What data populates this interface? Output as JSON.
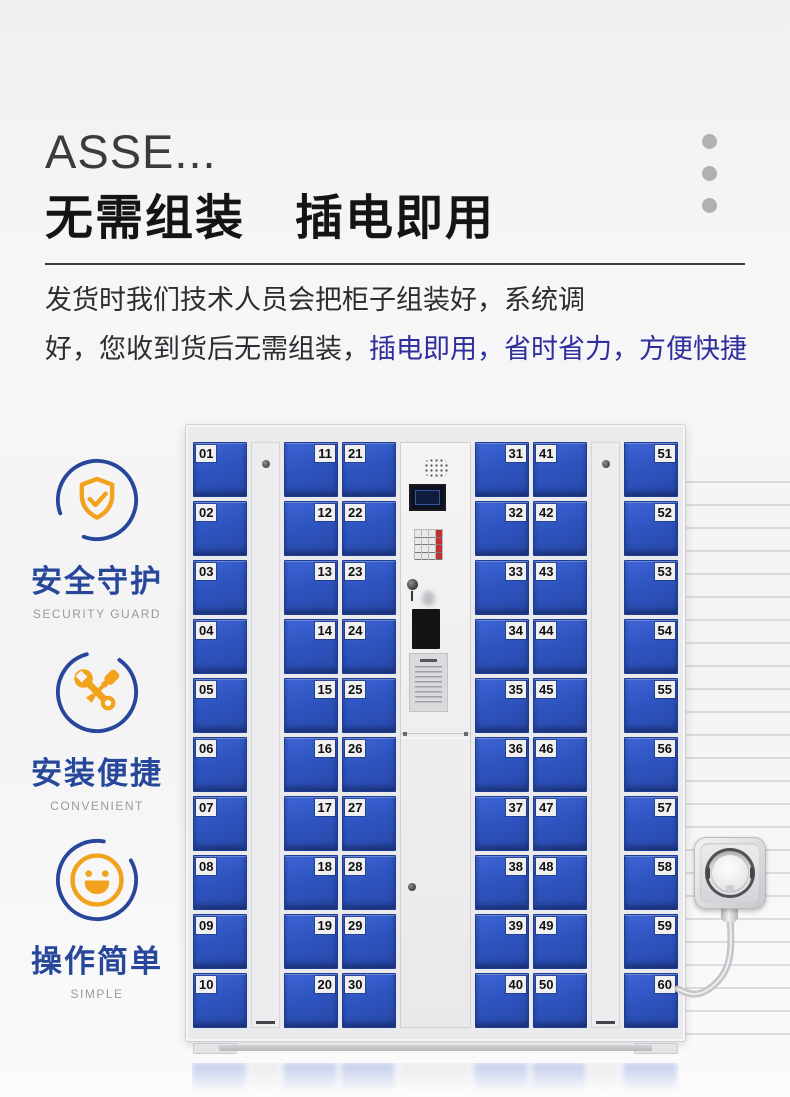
{
  "colors": {
    "accent-blue": "#26479a",
    "accent-orange": "#f2a21c",
    "door-blue": "#2e54c0",
    "highlight-text": "#2e2e9c"
  },
  "header": {
    "title_en": "ASSE...",
    "title_zh": "无需组装　插电即用"
  },
  "description": {
    "line1": "发货时我们技术人员会把柜子组装好，系统调",
    "line2_plain": "好，您收到货后无需组装，",
    "line2_highlight": "插电即用，省时省力，方便快捷"
  },
  "features": [
    {
      "icon": "shield-check-icon",
      "title": "安全守护",
      "subtitle": "SECURITY GUARD"
    },
    {
      "icon": "tools-icon",
      "title": "安装便捷",
      "subtitle": "CONVENIENT"
    },
    {
      "icon": "smiley-icon",
      "title": "操作简单",
      "subtitle": "SIMPLE"
    }
  ],
  "locker": {
    "layout": [
      "doors",
      "spacer",
      "doors",
      "doors",
      "console",
      "doors",
      "doors",
      "spacer",
      "doors"
    ],
    "columns": [
      {
        "label_side": "left",
        "numbers": [
          "01",
          "02",
          "03",
          "04",
          "05",
          "06",
          "07",
          "08",
          "09",
          "10"
        ]
      },
      {
        "label_side": "right",
        "numbers": [
          "11",
          "12",
          "13",
          "14",
          "15",
          "16",
          "17",
          "18",
          "19",
          "20"
        ]
      },
      {
        "label_side": "left",
        "numbers": [
          "21",
          "22",
          "23",
          "24",
          "25",
          "26",
          "27",
          "28",
          "29",
          "30"
        ]
      },
      {
        "label_side": "right",
        "numbers": [
          "31",
          "32",
          "33",
          "34",
          "35",
          "36",
          "37",
          "38",
          "39",
          "40"
        ]
      },
      {
        "label_side": "left",
        "numbers": [
          "41",
          "42",
          "43",
          "44",
          "45",
          "46",
          "47",
          "48",
          "49",
          "50"
        ]
      },
      {
        "label_side": "right",
        "numbers": [
          "51",
          "52",
          "53",
          "54",
          "55",
          "56",
          "57",
          "58",
          "59",
          "60"
        ]
      }
    ]
  }
}
